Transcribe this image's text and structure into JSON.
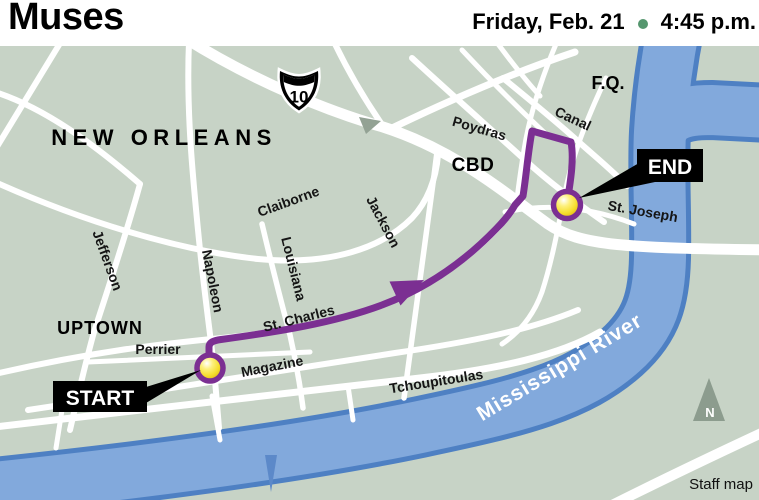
{
  "header": {
    "title": "Muses",
    "date": "Friday, Feb. 21",
    "time": "4:45 p.m.",
    "separator_color": "#55966e"
  },
  "map": {
    "regions": {
      "city": "NEW ORLEANS",
      "uptown": "UPTOWN",
      "cbd": "CBD",
      "french_quarter": "F.Q."
    },
    "streets": {
      "jefferson": "Jefferson",
      "napoleon": "Napoleon",
      "louisiana": "Louisiana",
      "claiborne": "Claiborne",
      "jackson": "Jackson",
      "st_charles": "St. Charles",
      "perrier": "Perrier",
      "magazine": "Magazine",
      "tchoupitoulas": "Tchoupitoulas",
      "poydras": "Poydras",
      "canal": "Canal",
      "st_joseph": "St. Joseph"
    },
    "water": {
      "river": "Mississippi River"
    },
    "highway": {
      "interstate": "10"
    },
    "route": {
      "start": "START",
      "end": "END",
      "color": "#7b2f92"
    },
    "compass": {
      "north": "N"
    },
    "credit": "Staff map",
    "colors": {
      "land": "#c7d3c6",
      "road": "#ffffff",
      "river": "#82a9dc",
      "river_edge": "#4e80c3",
      "marker_ring": "#7b2f92",
      "marker_fill": "#f5dd2b"
    }
  }
}
